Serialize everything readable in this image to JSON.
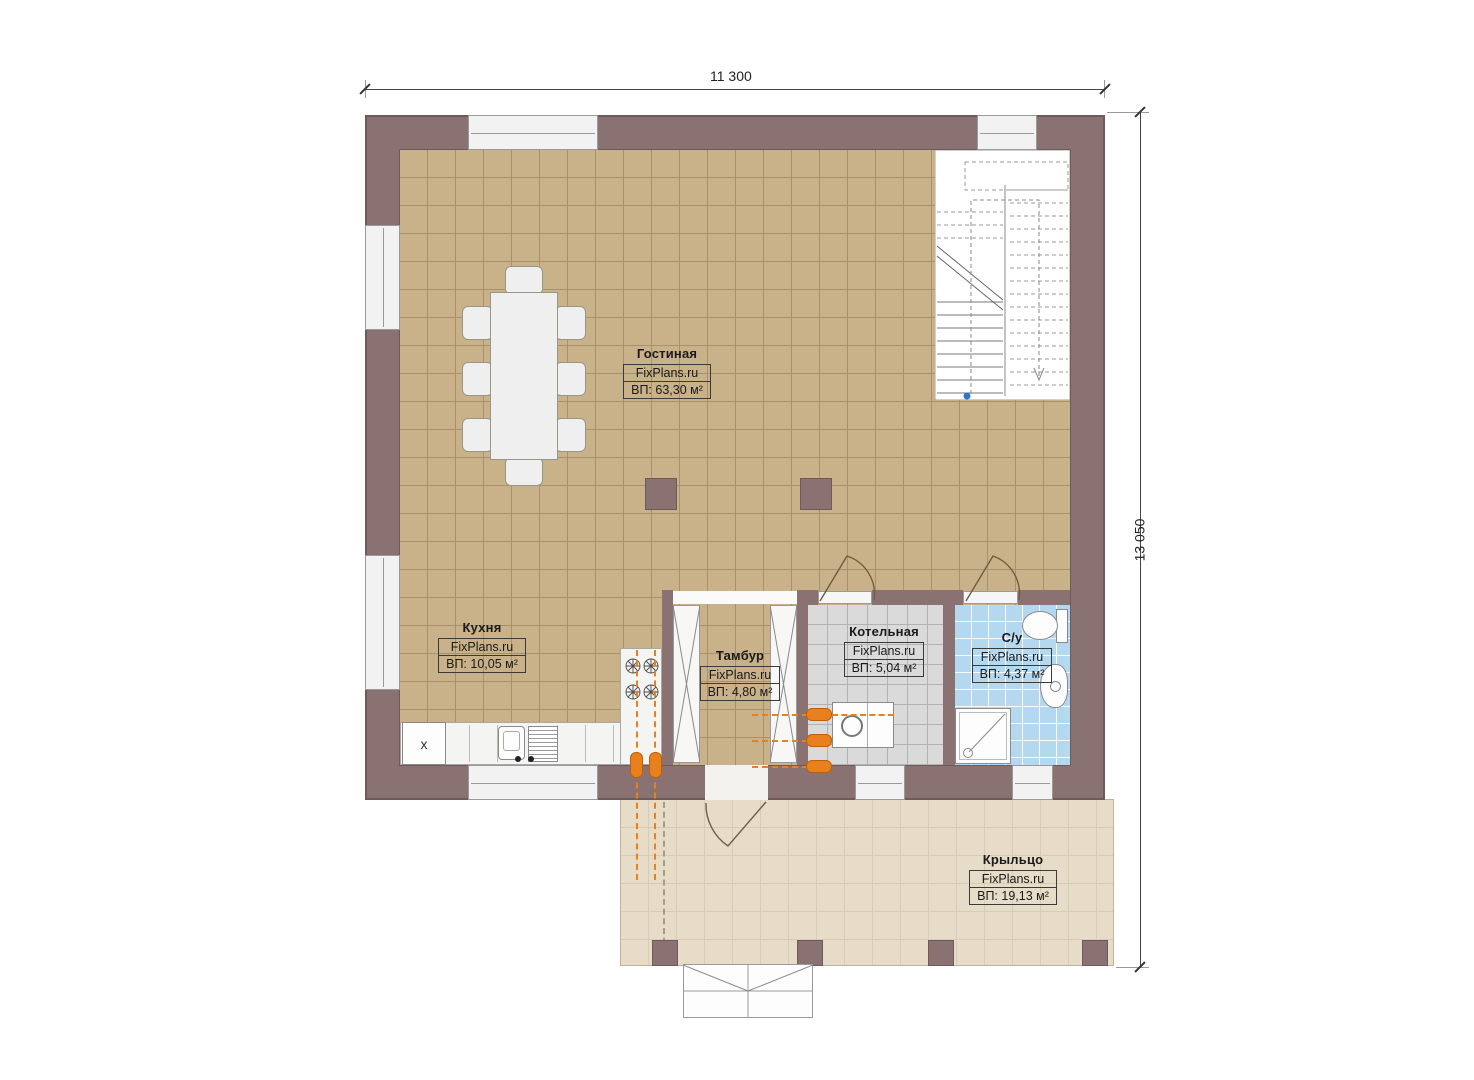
{
  "plan_title": "First floor plan",
  "dimensions": {
    "width_label": "11 300",
    "height_label": "13 050"
  },
  "rooms": [
    {
      "id": "living",
      "name": "Гостиная",
      "brand": "FixPlans.ru",
      "area": "ВП: 63,30 м²"
    },
    {
      "id": "kitchen",
      "name": "Кухня",
      "brand": "FixPlans.ru",
      "area": "ВП: 10,05 м²"
    },
    {
      "id": "tambour",
      "name": "Тамбур",
      "brand": "FixPlans.ru",
      "area": "ВП: 4,80 м²"
    },
    {
      "id": "boiler",
      "name": "Котельная",
      "brand": "FixPlans.ru",
      "area": "ВП: 5,04 м²"
    },
    {
      "id": "bathroom",
      "name": "С/у",
      "brand": "FixPlans.ru",
      "area": "ВП: 4,37 м²"
    },
    {
      "id": "porch",
      "name": "Крыльцо",
      "brand": "FixPlans.ru",
      "area": "ВП: 19,13 м²"
    }
  ],
  "fixtures": {
    "kitchen_cabinet_marker": "x"
  },
  "colors": {
    "wall": "#8a7272",
    "living_floor": "#c9b189",
    "floor_grid": "#a8926e",
    "boiler_floor": "#dadada",
    "bath_floor": "#b5d8f1",
    "porch_floor": "#e7dcc7",
    "heating_accent": "#e8801e",
    "stair_marker_blue": "#2e75c8",
    "dimension_text": "#222222"
  }
}
